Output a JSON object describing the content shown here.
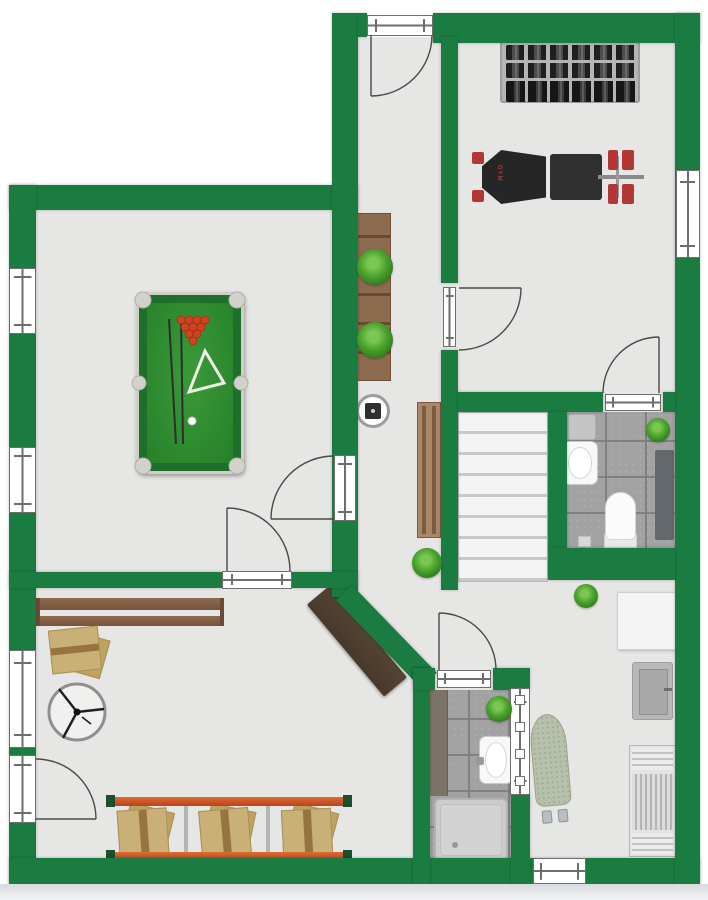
{
  "plan": {
    "type": "basement-floor-plan",
    "labels": {
      "bench_brand": "GYM"
    },
    "colors": {
      "wall": "#1b7c42",
      "floor": "#e6e6e4",
      "tile": "#a2a2a2",
      "wood": "#8d6b4e",
      "deskDark": "#47392b",
      "railOrange": "#c85427",
      "postGreen": "#1c4f2e",
      "box": "#c9b076",
      "boxTape": "#97743f",
      "felt": "#2f8c30",
      "tableRail": "#1d6f2b",
      "tableEdge": "#cfcfc6",
      "ballRed": "#d4411f",
      "equipmentBlack": "#2b2b2b",
      "plateRed": "#b23838",
      "rackGray": "#b5b5b5",
      "matDark": "#62686c",
      "ironing": "#b7c0aa",
      "lineColor": "#4a4a4a"
    }
  },
  "rooms": [
    {
      "id": "billiard-room",
      "furniture": [
        "pool-table",
        "cue-sticks",
        "triangle-rack",
        "billiard-balls"
      ]
    },
    {
      "id": "entry-hallway",
      "furniture": [
        "console-table",
        "potted-plant",
        "potted-plant",
        "round-side-table",
        "wall-bench"
      ]
    },
    {
      "id": "gym",
      "furniture": [
        "dumbbell-rack",
        "weight-bench"
      ]
    },
    {
      "id": "bathroom-upper",
      "furniture": [
        "shower-square",
        "sink",
        "toilet",
        "shower-mat",
        "potted-plant"
      ]
    },
    {
      "id": "stairwell",
      "furniture": [
        "stairs"
      ]
    },
    {
      "id": "storage-room",
      "furniture": [
        "wall-shelf",
        "cardboard-boxes",
        "floor-fan",
        "storage-rack",
        "corner-desk"
      ]
    },
    {
      "id": "bathroom-lower",
      "furniture": [
        "counter",
        "sink",
        "shower-tray",
        "potted-plant",
        "sliding-door"
      ]
    },
    {
      "id": "utility-room",
      "furniture": [
        "side-table",
        "cabinet",
        "ironing-board",
        "drying-rack",
        "potted-plant"
      ]
    }
  ],
  "counts": {
    "windows": 5,
    "door-swings": 7,
    "plants": 6,
    "stair-treads": 8
  }
}
